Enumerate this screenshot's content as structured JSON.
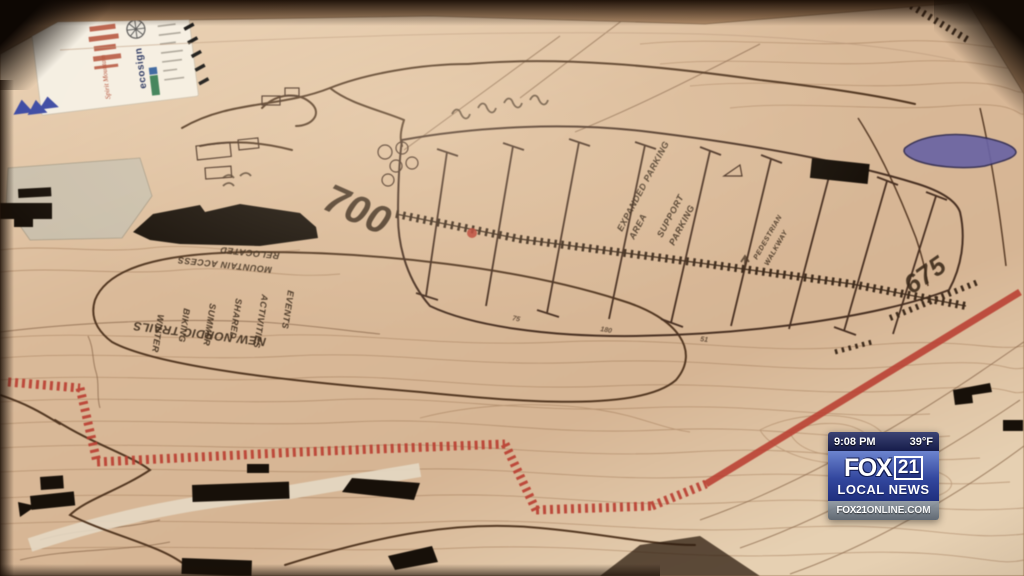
{
  "overlay": {
    "time": "9:08 PM",
    "temp": "39°F",
    "station": "FOX",
    "channel": "21",
    "tagline": "LOCAL NEWS",
    "site_bold": "FOX21",
    "site_rest": "ONLINE.COM"
  },
  "title_block": {
    "firm": "ecosign",
    "resort": "Spirit Mountain"
  },
  "map": {
    "elevation_700": "700",
    "elevation_675": "675",
    "nordic_label": "NEW NORDIC TRAILS",
    "relocated_line1": "RELOCATED",
    "relocated_line2": "MOUNTAIN ACCESS",
    "activity_words": [
      "WINTER",
      "BIKING",
      "SUMMER",
      "SHARED",
      "ACTIVITIES",
      "EVENTS"
    ],
    "parking_label1_line1": "EXPANDED PARKING",
    "parking_label1_line2": "AREA",
    "parking_label2_line1": "SUPPORT",
    "parking_label2_line2": "PARKING",
    "walkway_line1": "PEDESTRIAN",
    "walkway_line2": "WALKWAY",
    "row_counts": [
      "75",
      "180",
      "51"
    ]
  },
  "colors": {
    "boundary_red": "#c23b2e",
    "lake_blue": "#6a64a8",
    "ink": "#3a2817",
    "badge_blue": "#2b3c8e"
  }
}
